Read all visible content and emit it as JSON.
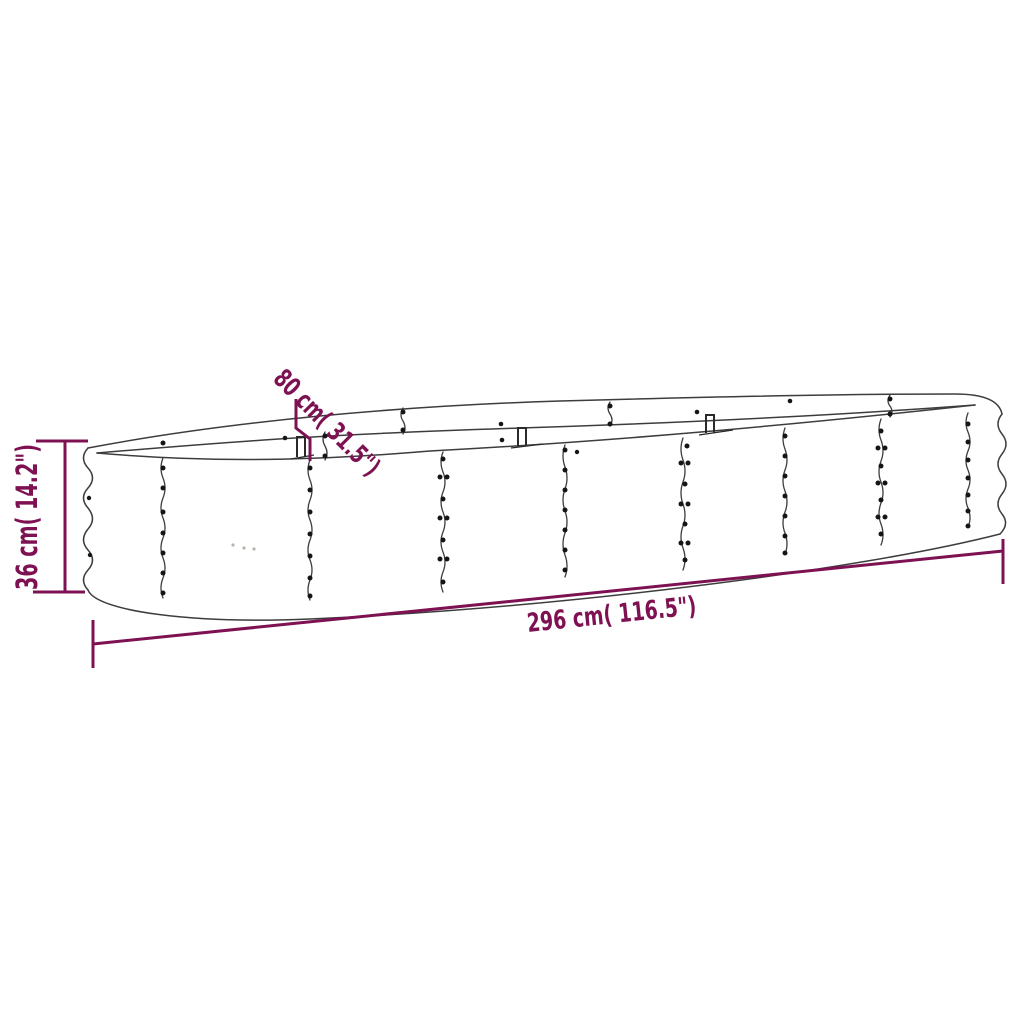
{
  "diagram": {
    "product": "oval-raised-garden-bed-line-drawing",
    "dimensions": {
      "width": {
        "label": "80 cm( 31.5\")",
        "cm": 80,
        "inches": 31.5
      },
      "height": {
        "label": "36 cm( 14.2\")",
        "cm": 36,
        "inches": 14.2
      },
      "length": {
        "label": "296 cm( 116.5\")",
        "cm": 296,
        "inches": 116.5
      }
    }
  },
  "colors": {
    "background": "#ffffff",
    "line": "#3d3d3d",
    "bolt": "#151515",
    "clip": "#2a2a2a",
    "dimension": "#7e1152"
  }
}
